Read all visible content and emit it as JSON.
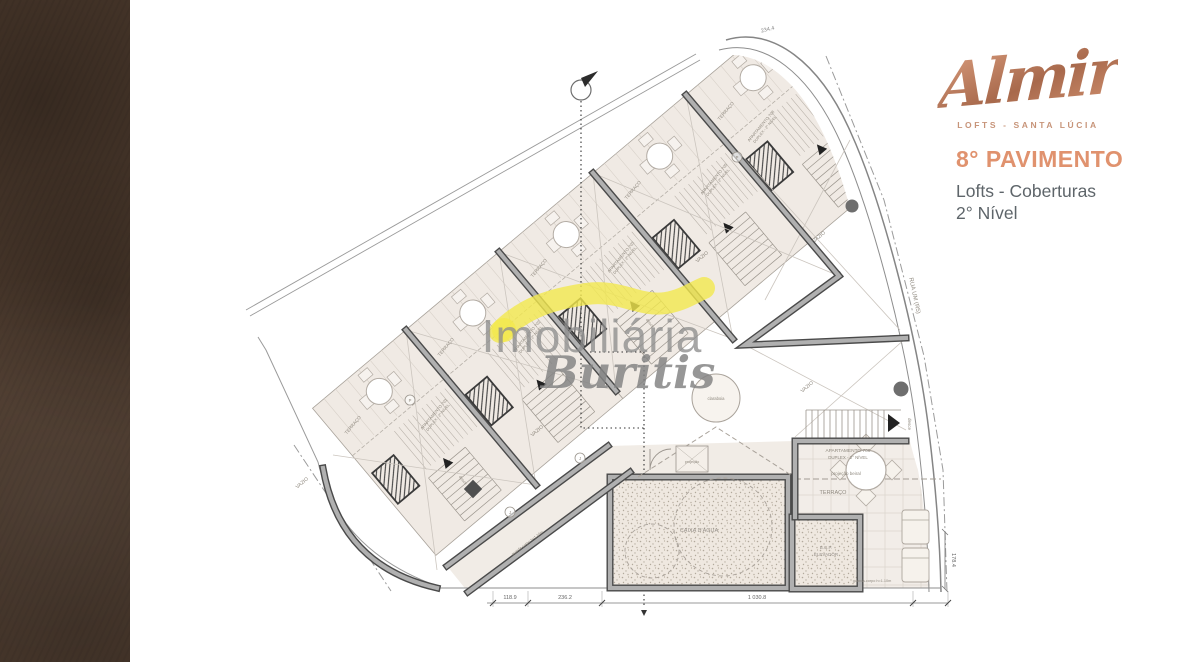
{
  "brand": {
    "logo_text": "Almir",
    "logo_sub": "LOFTS - SANTA LÚCIA"
  },
  "panel": {
    "title": "8° PAVIMENTO",
    "line1": "Lofts - Coberturas",
    "line2": "2° Nível",
    "title_color": "#e0926e",
    "text_color": "#5e656a"
  },
  "watermark": {
    "line1": "Imobiliária",
    "line2": "Buritis",
    "highlight_color": "#f3e94e"
  },
  "plan": {
    "street_label": "RUA UM (R5)",
    "units": [
      {
        "name": "APARTAMENTO 701",
        "level": "DUPLEX - 2° NÍVEL"
      },
      {
        "name": "APARTAMENTO 702",
        "level": "DUPLEX - 2° NÍVEL"
      },
      {
        "name": "APARTAMENTO 703",
        "level": "DUPLEX - 2° NÍVEL"
      },
      {
        "name": "APARTAMENTO 705",
        "level": "DUPLEX - 2° NÍVEL"
      },
      {
        "name": "APARTAMENTO 708",
        "level": "DUPLEX - 2° NÍVEL"
      },
      {
        "name": "APARTAMENTO 706",
        "level": "DUPLEX - 2° NÍVEL"
      }
    ],
    "labels": {
      "terrace": "TERRAÇO",
      "void": "VAZIO",
      "down": "desce",
      "skylight": "claraboia",
      "water_tank": "CAIXA D'ÁGUA",
      "elevator1": "B.C.P.",
      "elevator2": "ELEVADOR",
      "eave": "projeção beiral",
      "projection": "projeção",
      "railing": "guarda-corpo h=1.10m"
    },
    "markers": [
      "P",
      "P",
      "J",
      "J"
    ],
    "dimensions": {
      "bottom": [
        "118.9",
        "236.2",
        "1 030.8"
      ],
      "right": "178.4",
      "top": "234.4"
    }
  }
}
